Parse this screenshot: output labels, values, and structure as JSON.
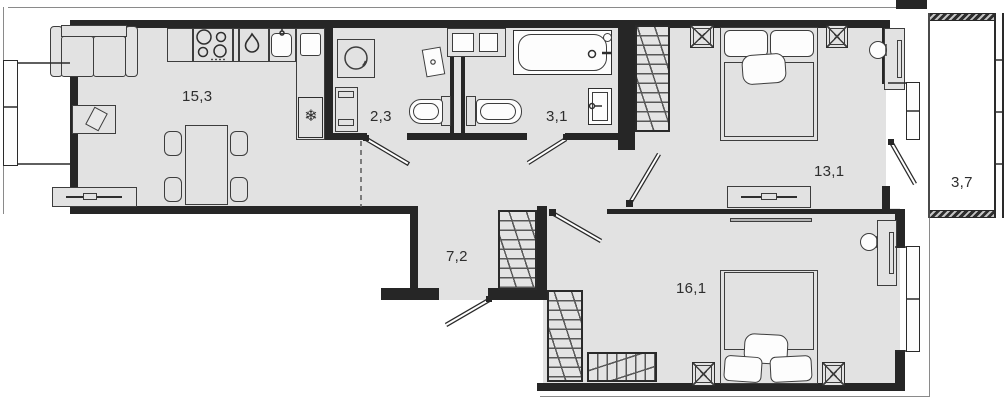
{
  "floor_plan": {
    "labels": {
      "living_kitchen": "15,3",
      "wc": "2,3",
      "bathroom": "3,1",
      "bedroom_1": "13,1",
      "balcony": "3,7",
      "hallway": "7,2",
      "bedroom_2": "16,1"
    },
    "icons": {
      "fridge_icon": "❄"
    },
    "colors": {
      "floor": "#e2e2e2",
      "wall": "#262626",
      "fixture": "#fdfdfd",
      "outline": "#8a8a8a"
    }
  }
}
